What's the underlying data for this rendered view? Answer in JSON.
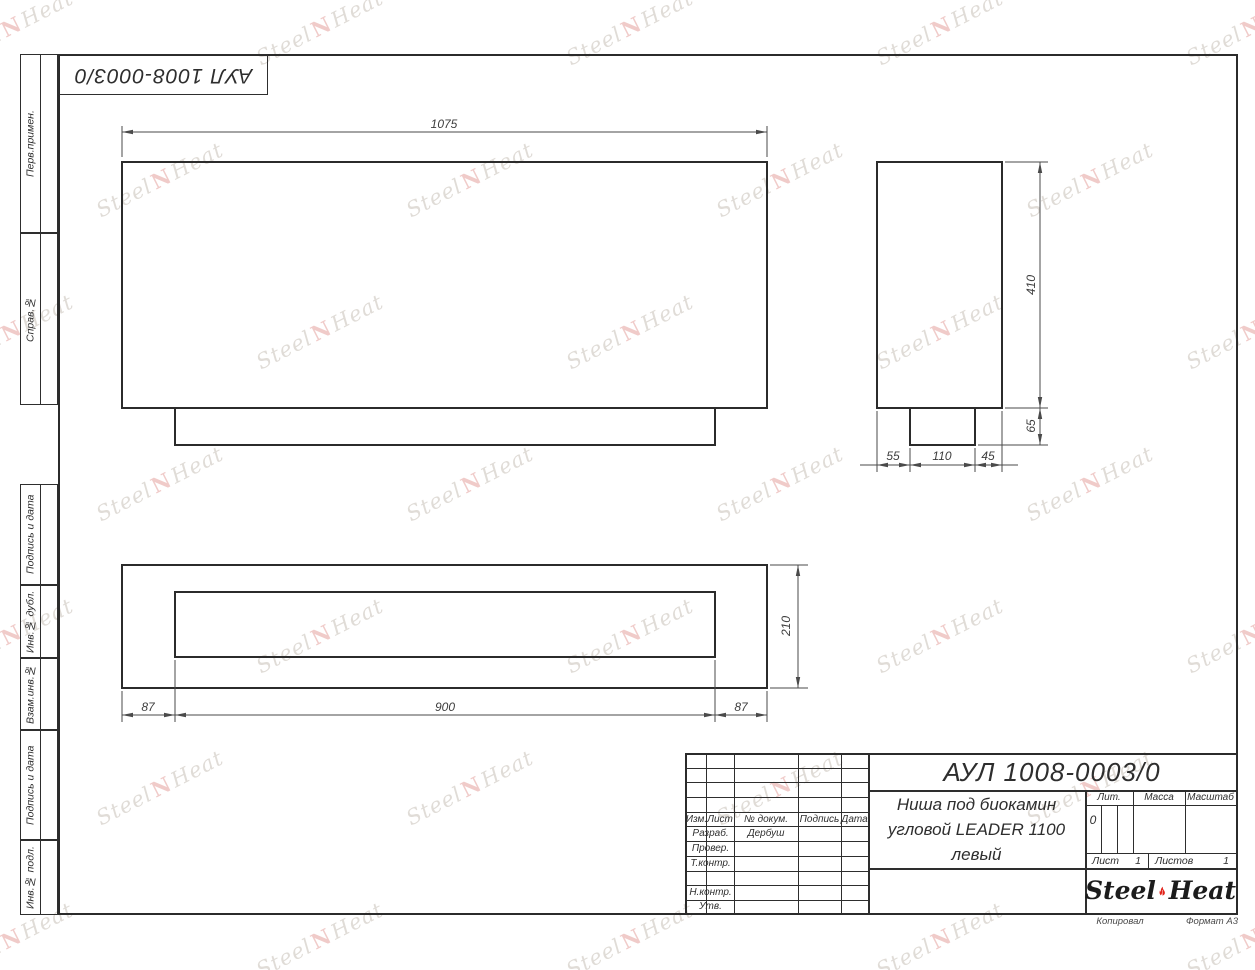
{
  "sheet": {
    "stamp_code": "АУЛ 1008-0003/0"
  },
  "side_labels": [
    "Перв.примен.",
    "Справ.№",
    "Подпись и дата",
    "Инв.№ дубл.",
    "Взам.инв.№",
    "Подпись и дата",
    "Инв.№ подл."
  ],
  "dims": {
    "front_width": "1075",
    "height": "410",
    "plinth_height": "65",
    "depth_front": "55",
    "depth_mid": "110",
    "depth_back": "45",
    "plan_left": "87",
    "plan_center": "900",
    "plan_right": "87",
    "plan_depth": "210"
  },
  "title_block": {
    "doc_code": "АУЛ 1008-0003/0",
    "title_line1": "Ниша под биокамин",
    "title_line2": "угловой LEADER 1100",
    "title_line3": "левый",
    "lit_label": "Лит.",
    "lit_value": "0",
    "mass_label": "Масса",
    "scale_label": "Масштаб",
    "sheet_label": "Лист",
    "sheet_value": "1",
    "sheets_label": "Листов",
    "sheets_value": "1",
    "header": {
      "izm": "Изм.",
      "list": "Лист",
      "doc": "№ докум.",
      "sign": "Подпись",
      "date": "Дата"
    },
    "rows": {
      "razrab": "Разраб.",
      "razrab_value": "Дербуш",
      "prover": "Провер.",
      "tkontr": "Т.контр.",
      "nkontr": "Н.контр.",
      "utv": "Утв."
    },
    "logo_left": "Steel",
    "logo_right": "Heat"
  },
  "footer": {
    "copied": "Копировал",
    "format": "Формат А3"
  },
  "watermark": {
    "text_left": "Steel",
    "mark": "N",
    "text_right": "Heat",
    "color": "rgba(177,168,156,0.40)",
    "accent": "rgba(222,140,135,0.45)",
    "flame_red": "#e2231a"
  }
}
